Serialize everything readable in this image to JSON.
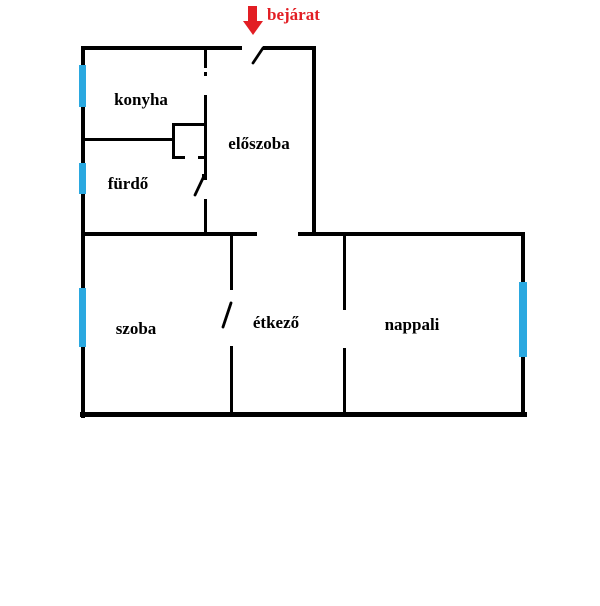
{
  "title": "apartment-floorplan",
  "colors": {
    "background": "#ffffff",
    "wall": "#000000",
    "window": "#2aa8e0",
    "entrance": "#e21e24",
    "room_label": "#000000"
  },
  "entrance": {
    "label": "bejárat",
    "arrow_icon": "red-down-arrow"
  },
  "rooms": [
    {
      "id": "room-label-konyha",
      "label": "konyha",
      "cx": 141,
      "cy": 100
    },
    {
      "id": "room-label-eloszoba",
      "label": "előszoba",
      "cx": 259,
      "cy": 144
    },
    {
      "id": "room-label-furdo",
      "label": "fürdő",
      "cx": 128,
      "cy": 184
    },
    {
      "id": "room-label-szoba",
      "label": "szoba",
      "cx": 136,
      "cy": 329
    },
    {
      "id": "room-label-etkezo",
      "label": "étkező",
      "cx": 276,
      "cy": 323
    },
    {
      "id": "room-label-nappali",
      "label": "nappali",
      "cx": 412,
      "cy": 325
    }
  ],
  "walls": [
    {
      "id": "wall-top-left",
      "x": 82,
      "y": 46,
      "w": 160,
      "h": 4
    },
    {
      "id": "wall-top-right",
      "x": 263,
      "y": 46,
      "w": 53,
      "h": 4
    },
    {
      "id": "wall-outer-left",
      "x": 81,
      "y": 46,
      "w": 4,
      "h": 372
    },
    {
      "id": "wall-upper-right",
      "x": 312,
      "y": 46,
      "w": 4,
      "h": 190
    },
    {
      "id": "wall-middle-left",
      "x": 82,
      "y": 232,
      "w": 175,
      "h": 4
    },
    {
      "id": "wall-middle-right",
      "x": 298,
      "y": 232,
      "w": 227,
      "h": 4
    },
    {
      "id": "wall-bottom",
      "x": 80,
      "y": 412,
      "w": 447,
      "h": 5
    },
    {
      "id": "wall-outer-right",
      "x": 521,
      "y": 233,
      "w": 4,
      "h": 184
    },
    {
      "id": "wall-konyha-furdo",
      "x": 82,
      "y": 138,
      "w": 91,
      "h": 3
    },
    {
      "id": "wall-eloszoba-top",
      "x": 204,
      "y": 46,
      "w": 3,
      "h": 22
    },
    {
      "id": "konyha-door-dot",
      "x": 204,
      "y": 72,
      "w": 3,
      "h": 4
    },
    {
      "id": "wall-eloszoba-mid",
      "x": 204,
      "y": 95,
      "w": 3,
      "h": 81
    },
    {
      "id": "furdo-door-hinge",
      "x": 202,
      "y": 174,
      "w": 5,
      "h": 6
    },
    {
      "id": "wall-eloszoba-bottom",
      "x": 204,
      "y": 199,
      "w": 3,
      "h": 37
    },
    {
      "id": "closet-top",
      "x": 172,
      "y": 123,
      "w": 35,
      "h": 3
    },
    {
      "id": "closet-left",
      "x": 172,
      "y": 123,
      "w": 3,
      "h": 36
    },
    {
      "id": "closet-bottom-left",
      "x": 172,
      "y": 156,
      "w": 13,
      "h": 3
    },
    {
      "id": "closet-bottom-right",
      "x": 198,
      "y": 156,
      "w": 9,
      "h": 3
    },
    {
      "id": "wall-szoba-etkezo-top",
      "x": 230,
      "y": 236,
      "w": 3,
      "h": 54
    },
    {
      "id": "wall-szoba-etkezo-bottom",
      "x": 230,
      "y": 346,
      "w": 3,
      "h": 67
    },
    {
      "id": "wall-etkezo-nappali-top",
      "x": 343,
      "y": 236,
      "w": 3,
      "h": 74
    },
    {
      "id": "wall-etkezo-nappali-bottom",
      "x": 343,
      "y": 348,
      "w": 3,
      "h": 65
    }
  ],
  "windows": [
    {
      "id": "window-konyha",
      "x": 79,
      "y": 65,
      "w": 7,
      "h": 42
    },
    {
      "id": "window-furdo",
      "x": 79,
      "y": 163,
      "w": 7,
      "h": 31
    },
    {
      "id": "window-szoba",
      "x": 79,
      "y": 288,
      "w": 7,
      "h": 59
    },
    {
      "id": "window-nappali",
      "x": 519,
      "y": 282,
      "w": 8,
      "h": 75
    }
  ],
  "door_leaves": [
    {
      "id": "entrance-door-leaf",
      "x1": 253,
      "y1": 63,
      "x2": 263,
      "y2": 48
    },
    {
      "id": "furdo-door-leaf",
      "x1": 195,
      "y1": 195,
      "x2": 204,
      "y2": 176
    },
    {
      "id": "szoba-door-leaf",
      "x1": 223,
      "y1": 327,
      "x2": 231,
      "y2": 303
    }
  ]
}
